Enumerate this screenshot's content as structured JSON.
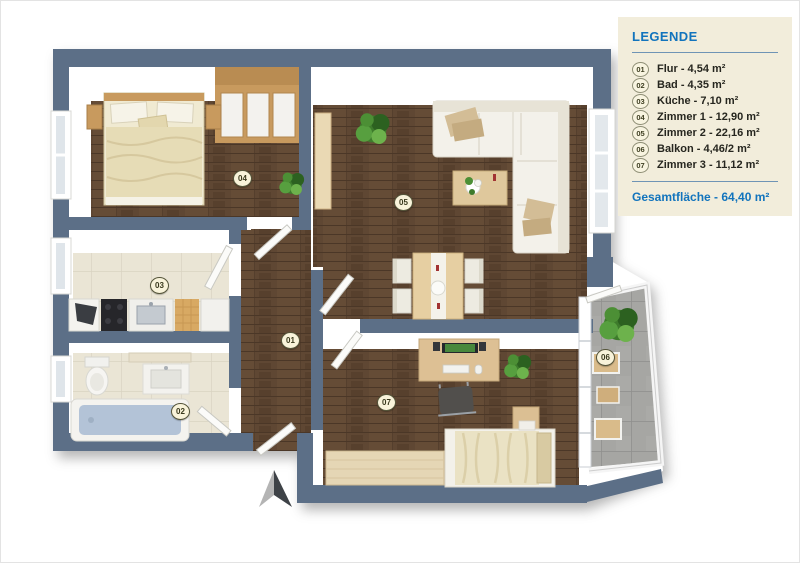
{
  "legend": {
    "title": "LEGENDE",
    "items": [
      {
        "number": "01",
        "label": "Flur - 4,54 m²"
      },
      {
        "number": "02",
        "label": "Bad - 4,35 m²"
      },
      {
        "number": "03",
        "label": "Küche - 7,10 m²"
      },
      {
        "number": "04",
        "label": "Zimmer 1 - 12,90 m²"
      },
      {
        "number": "05",
        "label": "Zimmer 2 - 22,16 m²"
      },
      {
        "number": "06",
        "label": "Balkon - 4,46/2 m²"
      },
      {
        "number": "07",
        "label": "Zimmer 3 - 11,12 m²"
      }
    ],
    "total": "Gesamtfläche - 64,40 m²"
  },
  "rooms": [
    {
      "number": "01",
      "name": "Flur"
    },
    {
      "number": "02",
      "name": "Bad"
    },
    {
      "number": "03",
      "name": "Küche"
    },
    {
      "number": "04",
      "name": "Zimmer 1"
    },
    {
      "number": "05",
      "name": "Zimmer 2"
    },
    {
      "number": "06",
      "name": "Balkon"
    },
    {
      "number": "07",
      "name": "Zimmer 3"
    }
  ],
  "icons": {
    "north-arrow": "two-tone triangle compass pointer"
  },
  "colors": {
    "wall": "#5c6f87",
    "wood_floor": "#5f4733",
    "tile_floor": "#eae5d5",
    "balcony_floor": "#a2a29f",
    "accent_blue": "#1274bd",
    "legend_bg": "#f2eddb"
  }
}
